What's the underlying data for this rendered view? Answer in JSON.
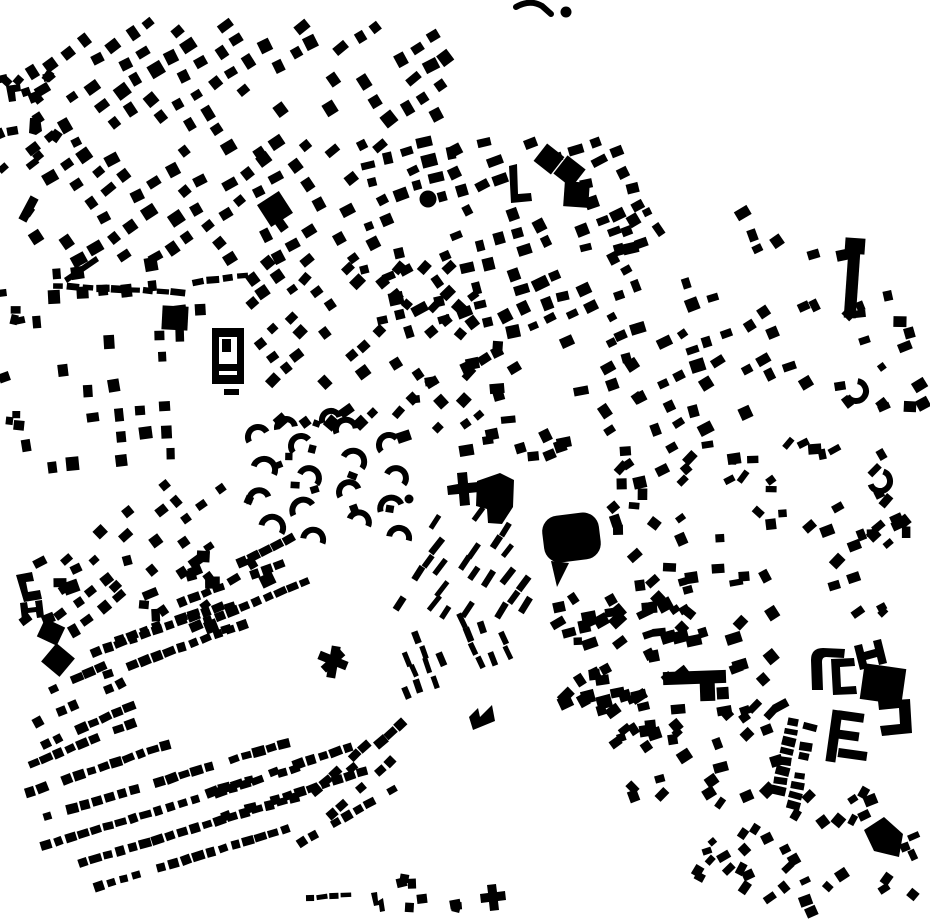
{
  "page": {
    "background": "#ffffff",
    "ink": "#000000"
  },
  "map": {
    "width": 930,
    "height": 924,
    "clusters": [
      {
        "id": "nw-grid-upper",
        "type": "grid",
        "seed": 11,
        "bbox": [
          25,
          18,
          435,
          140
        ],
        "angle": -33,
        "cell": 21,
        "rowGap": 21,
        "w": [
          9,
          15
        ],
        "h": [
          8,
          14
        ],
        "fill": 0.55,
        "rotJit": 14,
        "posJit": 2.5
      },
      {
        "id": "nw-grid-lower",
        "type": "grid",
        "seed": 12,
        "bbox": [
          25,
          150,
          340,
          115
        ],
        "angle": -33,
        "cell": 21,
        "rowGap": 21,
        "w": [
          9,
          15
        ],
        "h": [
          8,
          13
        ],
        "fill": 0.55,
        "rotJit": 14,
        "posJit": 2.5
      },
      {
        "id": "central-grid",
        "type": "grid",
        "seed": 13,
        "bbox": [
          355,
          135,
          290,
          205
        ],
        "angle": -20,
        "cell": 20,
        "rowGap": 19,
        "w": [
          8,
          16
        ],
        "h": [
          7,
          13
        ],
        "fill": 0.56,
        "rotJit": 18,
        "posJit": 2.5
      },
      {
        "id": "central-fan",
        "type": "grid",
        "seed": 14,
        "bbox": [
          248,
          255,
          235,
          180
        ],
        "angle": -42,
        "cell": 19,
        "rowGap": 18,
        "w": [
          8,
          14
        ],
        "h": [
          7,
          12
        ],
        "fill": 0.5,
        "rotJit": 16,
        "posJit": 2.5
      },
      {
        "id": "ne-grid",
        "type": "grid",
        "seed": 15,
        "bbox": [
          598,
          205,
          205,
          235
        ],
        "angle": -25,
        "cell": 21,
        "rowGap": 20,
        "w": [
          8,
          15
        ],
        "h": [
          7,
          13
        ],
        "fill": 0.5,
        "rotJit": 20,
        "posJit": 3
      },
      {
        "id": "west-grid",
        "type": "grid",
        "seed": 16,
        "bbox": [
          14,
          252,
          195,
          225
        ],
        "angle": 84,
        "cell": 24,
        "rowGap": 24,
        "w": [
          9,
          14
        ],
        "h": [
          8,
          13
        ],
        "fill": 0.55,
        "rotJit": 10,
        "posJit": 3
      },
      {
        "id": "west-fan",
        "type": "grid",
        "seed": 17,
        "bbox": [
          52,
          478,
          175,
          150
        ],
        "angle": -38,
        "cell": 20,
        "rowGap": 20,
        "w": [
          8,
          13
        ],
        "h": [
          7,
          11
        ],
        "fill": 0.5,
        "rotJit": 12,
        "posJit": 3
      },
      {
        "id": "mid-strips",
        "type": "grid",
        "seed": 18,
        "bbox": [
          393,
          508,
          140,
          110
        ],
        "angle": -55,
        "cell": 17,
        "rowGap": 15,
        "w": [
          14,
          19
        ],
        "h": [
          5,
          7
        ],
        "fill": 0.5,
        "rotJit": 8,
        "posJit": 2
      },
      {
        "id": "south-strips",
        "type": "grid",
        "seed": 19,
        "bbox": [
          398,
          612,
          120,
          85
        ],
        "angle": 68,
        "cell": 16,
        "rowGap": 16,
        "w": [
          12,
          16
        ],
        "h": [
          5,
          7
        ],
        "fill": 0.5,
        "rotJit": 8,
        "posJit": 2
      },
      {
        "id": "east-scatter",
        "type": "scatter",
        "seed": 20,
        "bbox": [
          612,
          440,
          300,
          175
        ],
        "n": 70,
        "w": [
          7,
          14
        ],
        "h": [
          6,
          12
        ],
        "angle": -25,
        "rotJit": 60
      },
      {
        "id": "far-east-scatter",
        "type": "scatter",
        "seed": 31,
        "bbox": [
          800,
          240,
          125,
          200
        ],
        "n": 22,
        "w": [
          7,
          14
        ],
        "h": [
          6,
          12
        ],
        "angle": -20,
        "rotJit": 50
      },
      {
        "id": "mid-band-scatter",
        "type": "scatter",
        "seed": 21,
        "bbox": [
          380,
          338,
          275,
          130
        ],
        "n": 30,
        "w": [
          9,
          15
        ],
        "h": [
          7,
          12
        ],
        "angle": -15,
        "rotJit": 40
      },
      {
        "id": "nw-edge-scatter",
        "type": "scatter",
        "seed": 22,
        "bbox": [
          0,
          58,
          62,
          175
        ],
        "n": 16,
        "w": [
          7,
          13
        ],
        "h": [
          6,
          11
        ],
        "angle": -30,
        "rotJit": 50
      },
      {
        "id": "west-edge-scatter",
        "type": "scatter",
        "seed": 23,
        "bbox": [
          0,
          280,
          20,
          190
        ],
        "n": 8,
        "w": [
          7,
          11
        ],
        "h": [
          6,
          10
        ],
        "angle": 0,
        "rotJit": 40
      },
      {
        "id": "se-upper-scatter",
        "type": "scatter",
        "seed": 24,
        "bbox": [
          558,
          598,
          225,
          105
        ],
        "n": 55,
        "w": [
          8,
          16
        ],
        "h": [
          7,
          13
        ],
        "angle": -25,
        "rotJit": 45
      },
      {
        "id": "se-mid-scatter",
        "type": "scatter",
        "seed": 25,
        "bbox": [
          595,
          702,
          195,
          95
        ],
        "n": 35,
        "w": [
          8,
          15
        ],
        "h": [
          7,
          12
        ],
        "angle": -25,
        "rotJit": 45
      },
      {
        "id": "se-tail-scatter",
        "type": "scatter",
        "seed": 26,
        "bbox": [
          690,
          788,
          225,
          125
        ],
        "n": 42,
        "w": [
          7,
          13
        ],
        "h": [
          6,
          11
        ],
        "angle": -40,
        "rotJit": 45
      },
      {
        "id": "crescent-sprinkle",
        "type": "scatter",
        "seed": 27,
        "bbox": [
          248,
          420,
          170,
          135
        ],
        "n": 10,
        "w": [
          7,
          10
        ],
        "h": [
          6,
          9
        ],
        "angle": 0,
        "rotJit": 60
      },
      {
        "id": "bottom-dots",
        "type": "scatter",
        "seed": 28,
        "bbox": [
          392,
          860,
          70,
          55
        ],
        "n": 8,
        "w": [
          8,
          11
        ],
        "h": [
          7,
          10
        ],
        "angle": 0,
        "rotJit": 30
      },
      {
        "id": "sw-upper-scatter",
        "type": "scatter",
        "seed": 29,
        "bbox": [
          15,
          556,
          290,
          85
        ],
        "n": 22,
        "w": [
          8,
          16
        ],
        "h": [
          7,
          13
        ],
        "angle": -20,
        "rotJit": 50
      },
      {
        "id": "terrace-rows",
        "type": "rows",
        "seed": 30,
        "cw": 10,
        "ch": 8,
        "gap": 3,
        "fill": 0.84,
        "list": [
          [
            30,
            700,
            -25,
            85
          ],
          [
            38,
            722,
            -25,
            95
          ],
          [
            46,
            744,
            -24,
            100
          ],
          [
            22,
            768,
            -22,
            120
          ],
          [
            30,
            792,
            -19,
            150
          ],
          [
            35,
            820,
            -17,
            262
          ],
          [
            46,
            845,
            -17,
            262
          ],
          [
            58,
            870,
            -17,
            250
          ],
          [
            74,
            894,
            -17,
            225
          ],
          [
            96,
            652,
            -20,
            135
          ],
          [
            108,
            674,
            -20,
            148
          ],
          [
            182,
            602,
            -21,
            108
          ],
          [
            196,
            626,
            -22,
            118
          ],
          [
            242,
            562,
            -26,
            75
          ],
          [
            120,
            640,
            -20,
            85
          ],
          [
            212,
            792,
            -18,
            148
          ],
          [
            226,
            816,
            -18,
            148
          ],
          [
            316,
            790,
            -42,
            88
          ],
          [
            332,
            814,
            -42,
            88
          ],
          [
            302,
            842,
            -30,
            105
          ],
          [
            352,
            768,
            -42,
            66
          ],
          [
            793,
            722,
            102,
            82,
            7,
            12
          ],
          [
            810,
            727,
            102,
            82,
            7,
            12
          ],
          [
            310,
            898,
            -5,
            36,
            9,
            5
          ],
          [
            58,
            286,
            3,
            125,
            12,
            6
          ],
          [
            198,
            282,
            -8,
            55,
            12,
            6
          ]
        ]
      },
      {
        "id": "crescents",
        "type": "arcs",
        "strokeWidth": 6,
        "list": [
          [
            258,
            437,
            10,
            150,
            330
          ],
          [
            264,
            470,
            11,
            200,
            25
          ],
          [
            259,
            500,
            10,
            160,
            340
          ],
          [
            272,
            528,
            11,
            195,
            30
          ],
          [
            301,
            446,
            10,
            140,
            320
          ],
          [
            309,
            478,
            10,
            205,
            40
          ],
          [
            303,
            510,
            11,
            150,
            330
          ],
          [
            313,
            540,
            10,
            190,
            20
          ],
          [
            346,
            430,
            10,
            160,
            350
          ],
          [
            353,
            462,
            11,
            210,
            35
          ],
          [
            349,
            492,
            10,
            150,
            340
          ],
          [
            359,
            522,
            10,
            200,
            25
          ],
          [
            389,
            445,
            10,
            140,
            320
          ],
          [
            396,
            478,
            10,
            205,
            40
          ],
          [
            391,
            508,
            11,
            160,
            340
          ],
          [
            399,
            538,
            10,
            190,
            15
          ],
          [
            286,
            428,
            9,
            170,
            350
          ],
          [
            331,
            420,
            9,
            160,
            340
          ],
          [
            856,
            391,
            10,
            -80,
            150
          ],
          [
            880,
            481,
            10,
            -70,
            160
          ]
        ]
      }
    ],
    "shapes": [
      {
        "k": "path",
        "d": "M516,7 Q530,-1 542,6 L551,14",
        "sw": 6
      },
      {
        "k": "circle",
        "cx": 566,
        "cy": 12,
        "r": 5.5
      },
      {
        "k": "circle",
        "cx": 428,
        "cy": 199,
        "r": 8.5
      },
      {
        "k": "circle",
        "cx": 409,
        "cy": 499,
        "r": 4.5
      },
      {
        "k": "path",
        "d": "M212,328 h32 v56 h-32 z M219,337 h18 v38 h-18 z",
        "fr": "evenodd"
      },
      {
        "k": "rect",
        "x": 222,
        "y": 339,
        "w": 9,
        "h": 13
      },
      {
        "k": "rect",
        "x": 216,
        "y": 364,
        "w": 22,
        "h": 7
      },
      {
        "k": "rect",
        "x": 224,
        "y": 389,
        "w": 15,
        "h": 6
      },
      {
        "k": "rect",
        "x": 262,
        "y": 196,
        "w": 26,
        "h": 26,
        "r": -33
      },
      {
        "k": "rect",
        "x": 162,
        "y": 306,
        "w": 26,
        "h": 24,
        "r": 3
      },
      {
        "k": "path",
        "d": "M509,166 l8,-2 1,30 13,-1 1,8 -21,2 z"
      },
      {
        "k": "rect",
        "x": 538,
        "y": 148,
        "w": 22,
        "h": 22,
        "r": 38
      },
      {
        "k": "rect",
        "x": 558,
        "y": 160,
        "w": 23,
        "h": 23,
        "r": 38
      },
      {
        "k": "rect",
        "x": 564,
        "y": 182,
        "w": 25,
        "h": 25,
        "r": 4
      },
      {
        "k": "rect",
        "x": 846,
        "y": 252,
        "w": 12,
        "h": 66,
        "r": 4
      },
      {
        "k": "rect",
        "x": 845,
        "y": 238,
        "w": 20,
        "h": 16,
        "r": 4
      },
      {
        "k": "path",
        "d": "M447,486 l11,-2 -1,-11 10,-1 1,11 10,-1 1,10 -10,1 1,12 -10,1 -1,-12 -11,1 z"
      },
      {
        "k": "poly",
        "pts": "477,481 500,473 514,480 513,507 502,524 488,523 487,509 476,506"
      },
      {
        "k": "rect",
        "x": 543,
        "y": 514,
        "w": 57,
        "h": 47,
        "rx": 16,
        "r": -7
      },
      {
        "k": "poly",
        "pts": "551,561 569,563 557,587"
      },
      {
        "k": "path",
        "d": "M469,717 l9,-9 2,9 12,-12 3,16 -22,9 z"
      },
      {
        "k": "rect",
        "x": 318,
        "y": 656,
        "w": 30,
        "h": 9,
        "r": 22
      },
      {
        "k": "rect",
        "x": 329,
        "y": 646,
        "w": 9,
        "h": 32,
        "r": 10
      },
      {
        "k": "rect",
        "x": 320,
        "y": 657,
        "w": 26,
        "h": 8,
        "r": -42
      },
      {
        "k": "path",
        "d": "M16,575 l16,-3 2,9 -8,1 2,10 12,-2 2,9 -18,3 z"
      },
      {
        "k": "path",
        "d": "M20,603 l7,-1 1,6 8,-1 -1,-6 7,-1 2,17 -7,1 -1,-6 -8,1 1,6 -7,1 z"
      },
      {
        "k": "rect",
        "x": 46,
        "y": 648,
        "w": 24,
        "h": 24,
        "r": 40
      },
      {
        "k": "rect",
        "x": 40,
        "y": 622,
        "w": 22,
        "h": 20,
        "r": 25
      },
      {
        "k": "path",
        "d": "M371,893 l6,-1 1,9 5,-3 2,13 -5,1 -1,-7 -5,1 z"
      },
      {
        "k": "path",
        "d": "M480,894 l8,-1 -1,-8 9,-1 1,8 8,-1 1,9 -8,1 1,9 -9,1 -1,-9 -8,1 z"
      },
      {
        "k": "rect",
        "x": 663,
        "y": 671,
        "w": 63,
        "h": 13,
        "r": -2
      },
      {
        "k": "rect",
        "x": 700,
        "y": 682,
        "w": 15,
        "h": 19,
        "r": -2
      },
      {
        "k": "path",
        "d": "M812,690 l-1,-30 q0,-12 12,-12 l22,1 -1,9 -18,-1 q-4,0 -4,5 l1,28 z"
      },
      {
        "k": "path",
        "d": "M854,646 l8,-2 2,8 11,-3 -2,-8 8,-2 6,24 -8,2 -2,-8 -11,3 2,8 -8,2 z"
      },
      {
        "k": "path",
        "d": "M831,659 l23,-1 1,8 -15,1 1,20 15,-1 1,8 -24,1 z"
      },
      {
        "k": "rect",
        "x": 862,
        "y": 666,
        "w": 42,
        "h": 36,
        "r": 8
      },
      {
        "k": "rect",
        "x": 829,
        "y": 710,
        "w": 10,
        "h": 52,
        "r": 8
      },
      {
        "k": "rect",
        "x": 838,
        "y": 712,
        "w": 26,
        "h": 9,
        "r": 8
      },
      {
        "k": "rect",
        "x": 838,
        "y": 731,
        "w": 21,
        "h": 9,
        "r": 8
      },
      {
        "k": "rect",
        "x": 838,
        "y": 750,
        "w": 29,
        "h": 9,
        "r": 8
      },
      {
        "k": "path",
        "d": "M910,699 l2,34 -30,3 -2,-10 20,-2 -1,-16 -20,2 -1,-9 z"
      },
      {
        "k": "poly",
        "pts": "864,830 884,817 903,834 899,857 874,851"
      },
      {
        "k": "rect",
        "x": 24,
        "y": 196,
        "w": 9,
        "h": 26,
        "r": 28
      },
      {
        "k": "path",
        "d": "M64,278 L96,256 99,261 67,283 z"
      },
      {
        "k": "path",
        "d": "M6,86 l14,-2 1,7 -6,1 1,9 -7,1 z"
      },
      {
        "k": "path",
        "d": "M30,118 l10,-1 2,14 -6,4 -7,-2 z"
      }
    ]
  }
}
